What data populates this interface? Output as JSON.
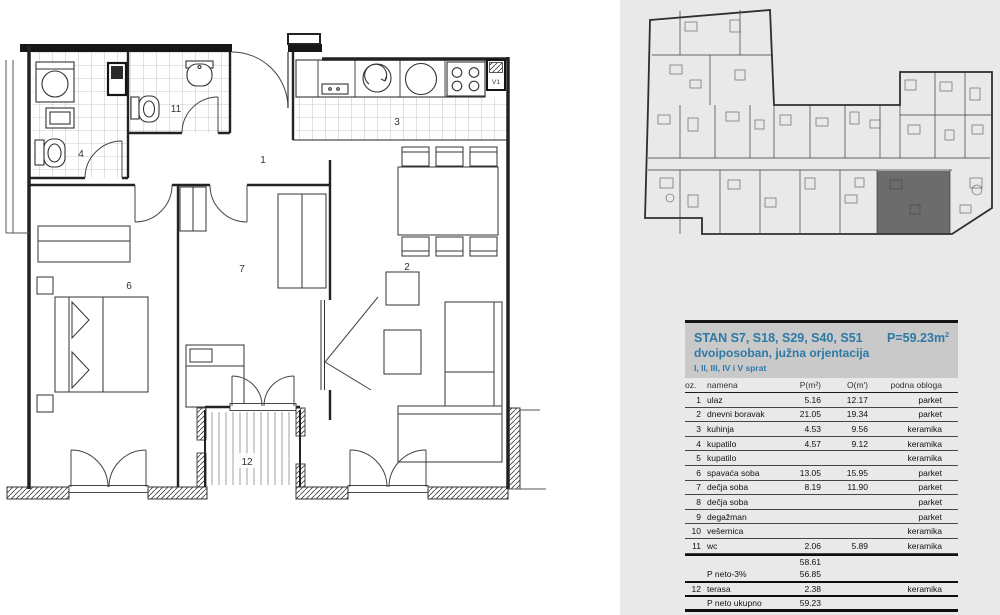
{
  "floorplan": {
    "labels": {
      "hall": "1",
      "living": "2",
      "kitchen": "3",
      "bath": "4",
      "bedroom": "6",
      "kids": "7",
      "wc": "11",
      "terrace": "12",
      "vent": "V1"
    }
  },
  "keyplan": {
    "highlight_color": "#3c3c3c"
  },
  "header": {
    "title": "STAN S7, S18, S29, S40, S51",
    "area": "P=59.23m",
    "area_sup": "2",
    "subtitle": "dvoiposoban, južna orjentacija",
    "floors": "I, II, III, IV i V sprat",
    "accent": "#2d79a6"
  },
  "table": {
    "col_oz": "oz.",
    "col_namena": "namena",
    "col_p": "P(m²)",
    "col_o": "O(m')",
    "col_obloga": "podna obloga",
    "rows": [
      {
        "oz": "1",
        "namena": "ulaz",
        "p": "5.16",
        "o": "12.17",
        "obloga": "parket"
      },
      {
        "oz": "2",
        "namena": "dnevni boravak",
        "p": "21.05",
        "o": "19.34",
        "obloga": "parket"
      },
      {
        "oz": "3",
        "namena": "kuhinja",
        "p": "4.53",
        "o": "9.56",
        "obloga": "keramika"
      },
      {
        "oz": "4",
        "namena": "kupatilo",
        "p": "4.57",
        "o": "9.12",
        "obloga": "keramika"
      },
      {
        "oz": "5",
        "namena": "kupatilo",
        "p": "",
        "o": "",
        "obloga": "keramika"
      },
      {
        "oz": "6",
        "namena": "spavaća soba",
        "p": "13.05",
        "o": "15.95",
        "obloga": "parket"
      },
      {
        "oz": "7",
        "namena": "dečja soba",
        "p": "8.19",
        "o": "11.90",
        "obloga": "parket"
      },
      {
        "oz": "8",
        "namena": "dečja soba",
        "p": "",
        "o": "",
        "obloga": "parket"
      },
      {
        "oz": "9",
        "namena": "degažman",
        "p": "",
        "o": "",
        "obloga": "parket"
      },
      {
        "oz": "10",
        "namena": "vešernica",
        "p": "",
        "o": "",
        "obloga": "keramika"
      },
      {
        "oz": "11",
        "namena": "wc",
        "p": "2.06",
        "o": "5.89",
        "obloga": "keramika"
      }
    ],
    "sum1_p": "58.61",
    "sum2_label": "P neto-3%",
    "sum2_p": "56.85",
    "r12_oz": "12",
    "r12_namena": "terasa",
    "r12_p": "2.38",
    "r12_obloga": "keramika",
    "total_label": "P neto ukupno",
    "total_p": "59.23"
  }
}
